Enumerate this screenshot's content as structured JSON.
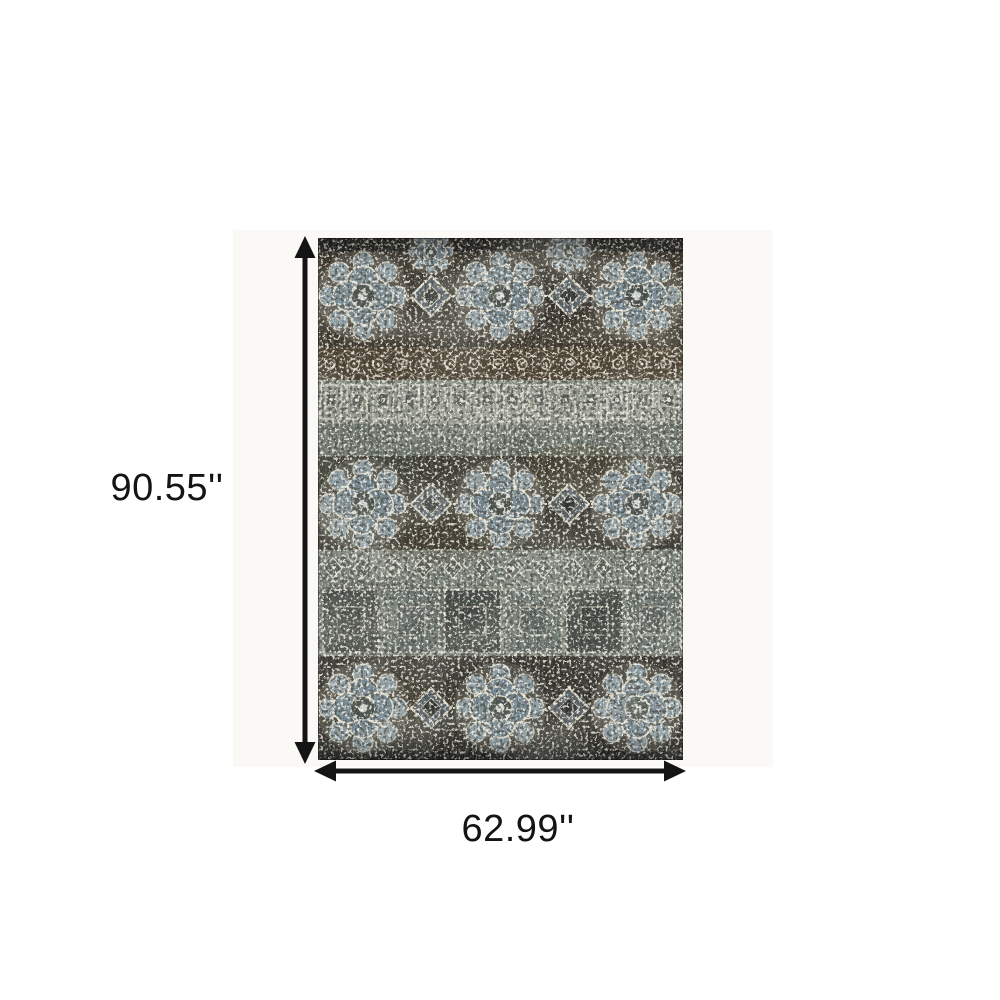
{
  "page": {
    "background": "#ffffff"
  },
  "colors": {
    "page_bg": "#ffffff",
    "arrow": "#141414",
    "label_text": "#141414",
    "backdrop": "#faf9f6"
  },
  "diagram": {
    "type": "product-dimensions",
    "product_name": "Distressed traditional oriental area rug",
    "height_label": "90.55''",
    "width_label": "62.99''",
    "height_value_inches": 90.55,
    "width_value_inches": 62.99,
    "rug_palette": {
      "charcoal": "#3a382f",
      "dark_edge": "#2b2a25",
      "brown": "#4e4230",
      "sage": "#8a9086",
      "slate_blue": "#74868f",
      "light_gray_blue": "#8fa0a7",
      "cream": "#ddd8c6"
    }
  }
}
